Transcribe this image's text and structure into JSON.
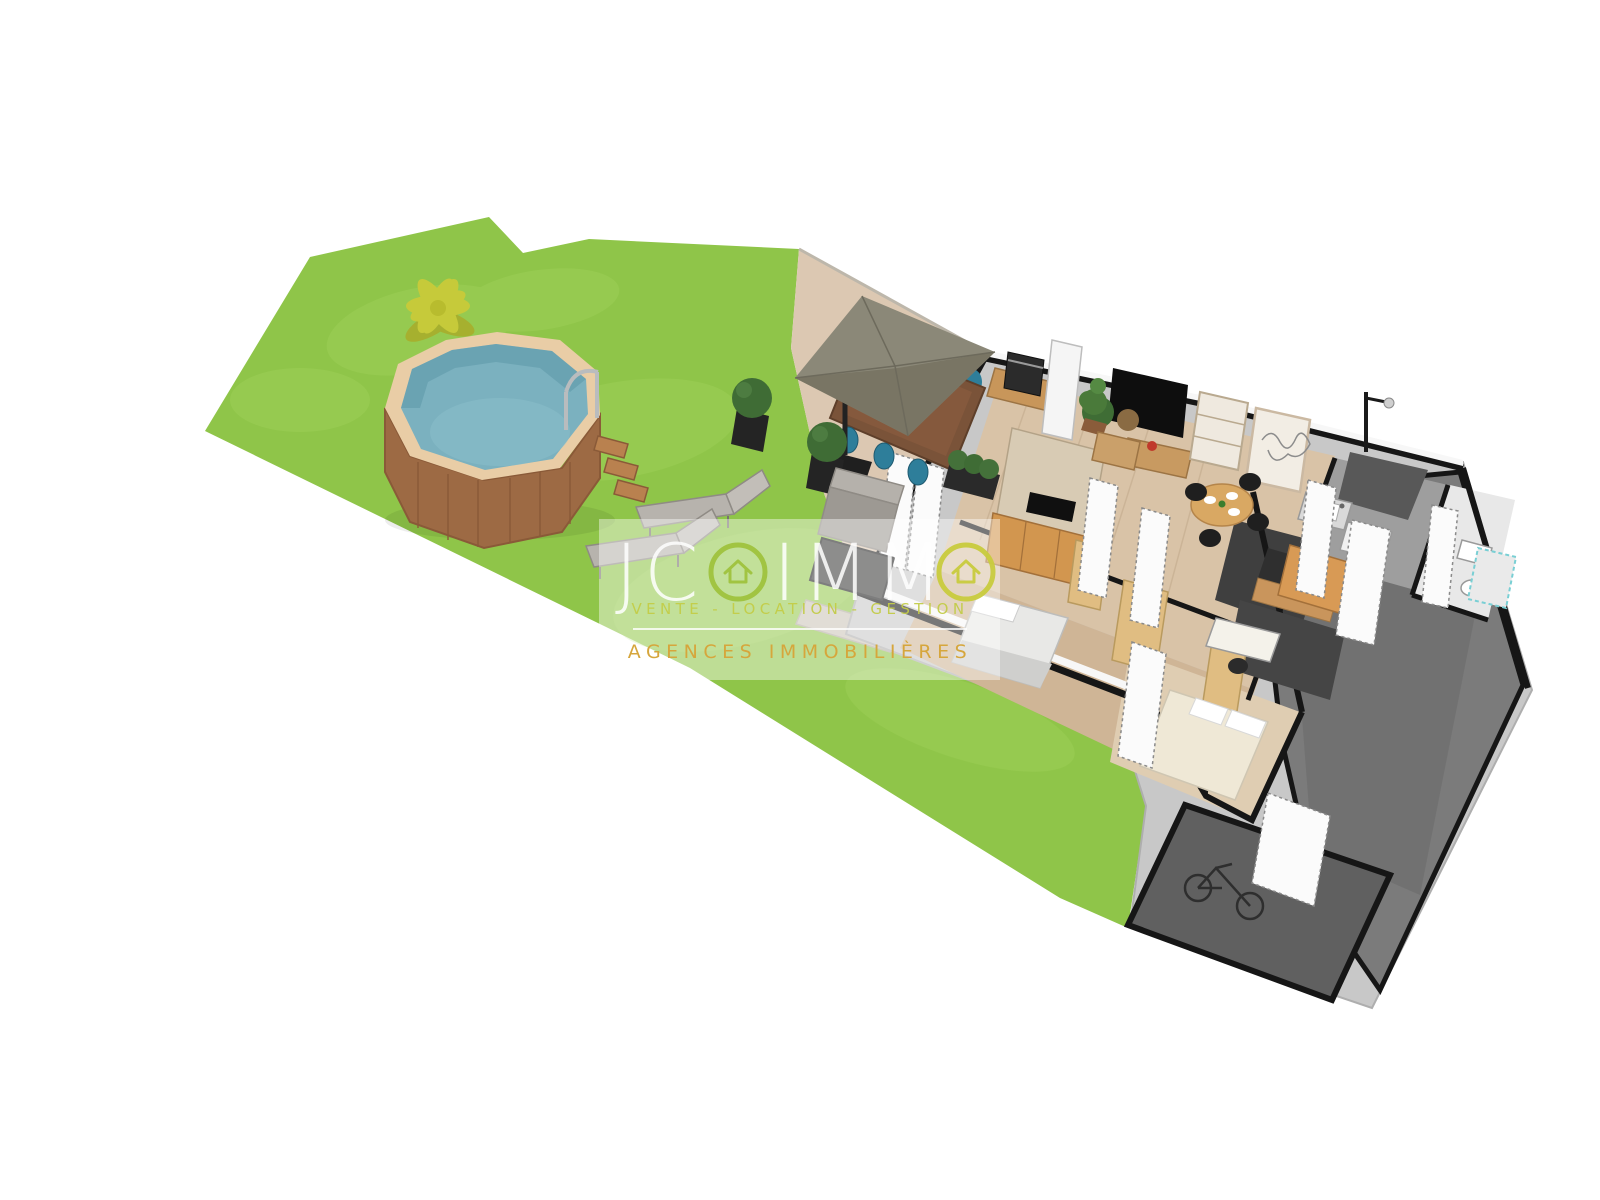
{
  "watermark": {
    "brand": {
      "prefix": "JC",
      "mid": "IMM"
    },
    "tagline": "VENTE - LOCATION - GESTION",
    "subtitle": "AGENCES IMMOBILIÈRES",
    "colors": {
      "panel": "rgba(255,255,255,0.42)",
      "logo_white": "#ffffff",
      "logo_green": "#9fc23e",
      "logo_yellow": "#c9cc3e",
      "tagline_olive": "#c3cc48",
      "subtitle_gold": "#d6a63c"
    }
  },
  "palette": {
    "grass": "#8fc549",
    "grass_light": "#a5d55f",
    "pool_water": "#7bb1bf",
    "pool_wood": "#9d6a44",
    "pool_rim": "#e9cda6",
    "palm": "#c6ca3a",
    "terrace": "#dcc8b2",
    "house_slab": "#c8c8c8",
    "wall_black": "#161616",
    "wood_floor": "#d9c3a7",
    "driveway": "#7b7b7b",
    "garage_floor": "#606060",
    "furniture_wood": "#d2964f",
    "oak": "#e0bd82",
    "chair_teal": "#2e7e9a",
    "parasol": "#8b8878",
    "sofa_gray": "#a9a59f"
  }
}
